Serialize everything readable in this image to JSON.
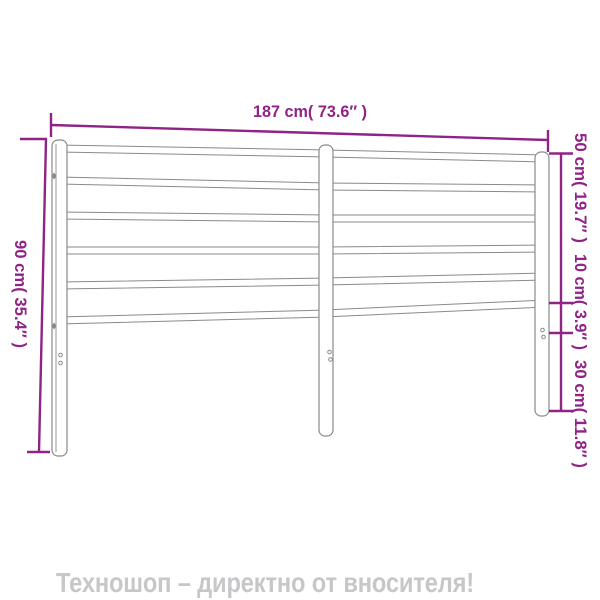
{
  "diagram": {
    "description": "metal-headboard-dimension-diagram",
    "width_label": "187 cm( 73.6″ )",
    "height_label": "90 cm( 35.4″ )",
    "right_labels": [
      "50 cm( 19.7″ )",
      "10 cm( 3.9″ )",
      "30 cm( 11.8″ )"
    ],
    "measurements": {
      "width": {
        "cm": "187",
        "inches": "73.6"
      },
      "height": {
        "cm": "90",
        "inches": "35.4"
      },
      "right_side_segments": [
        {
          "cm": "50",
          "inches": "19.7"
        },
        {
          "cm": "10",
          "inches": "3.9"
        },
        {
          "cm": "30",
          "inches": "11.8"
        }
      ]
    }
  },
  "footer": {
    "text": "Техношоп – директно от вносителя!"
  },
  "colors": {
    "dimension": "#8F2386",
    "outline": "#8a8a8a",
    "footer_text": "#c7c7c9",
    "background": "#ffffff"
  }
}
